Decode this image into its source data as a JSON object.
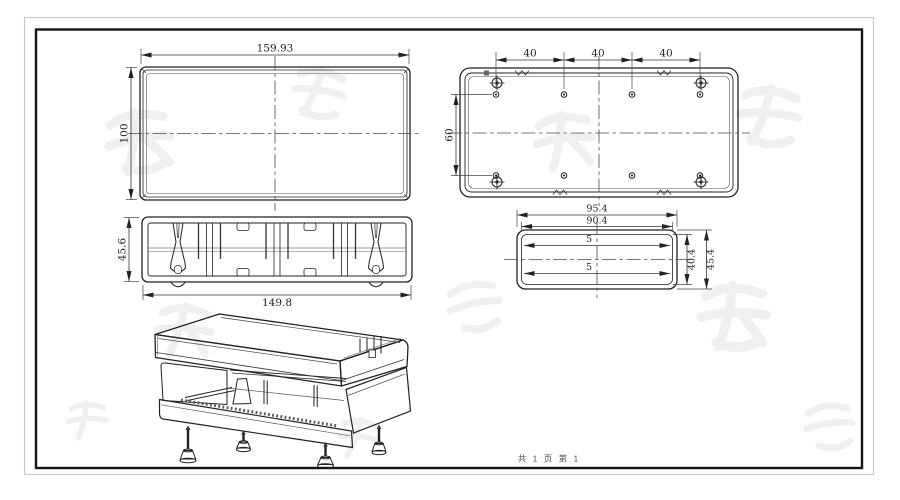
{
  "sheet": {
    "footer": "共 1 页  第 1"
  },
  "views": {
    "front": {
      "dim_width": "159.93",
      "dim_height": "100"
    },
    "plan": {
      "dim_hole_pitch_1": "40",
      "dim_hole_pitch_2": "40",
      "dim_hole_pitch_3": "40",
      "dim_row_spacing": "60"
    },
    "section": {
      "dim_height": "45.6",
      "dim_width": "149.8"
    },
    "end": {
      "dim_outer_width": "95.4",
      "dim_inner_width": "90.4",
      "dim_slot_top": "5",
      "dim_slot_bottom": "5",
      "dim_inner_height": "40.4",
      "dim_outer_height": "45.4"
    }
  }
}
